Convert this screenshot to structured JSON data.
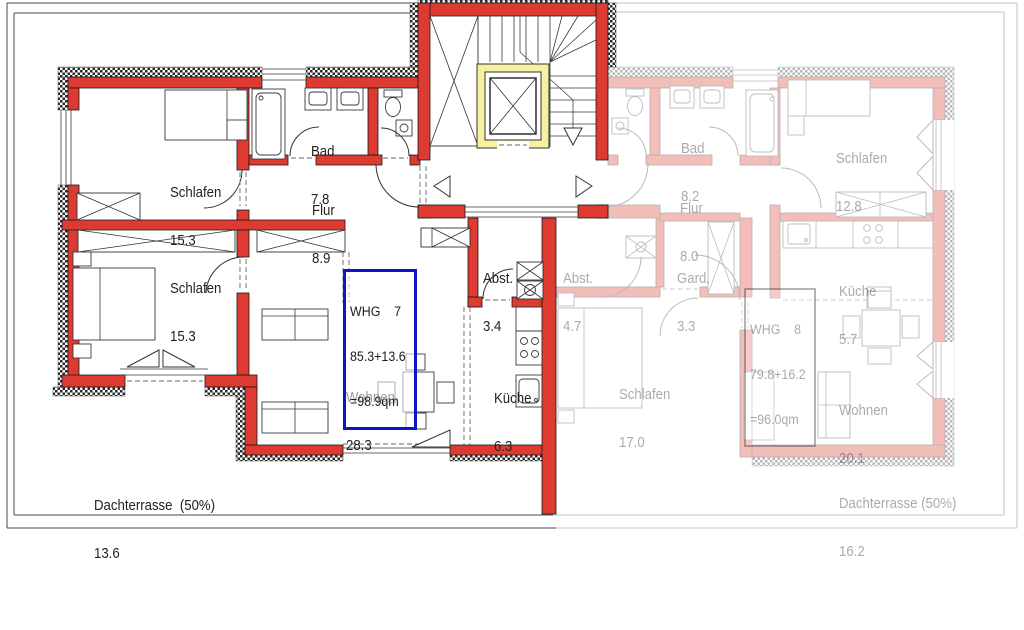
{
  "apartment_7": {
    "unit_box": {
      "line1": "WHG    7",
      "line2": "85.3+13.6",
      "line3": "=98.9qm"
    },
    "rooms": {
      "schlafen_top": {
        "name": "Schlafen",
        "area": "15.3"
      },
      "bad": {
        "name": "Bad",
        "area": "7.8"
      },
      "flur": {
        "name": "Flur",
        "area": "8.9"
      },
      "schlafen_bottom": {
        "name": "Schlafen",
        "area": "15.3"
      },
      "abstellraum": {
        "name": "Abst.",
        "area": "3.4"
      },
      "wohnen": {
        "name": "Wohnen",
        "area": "28.3"
      },
      "kueche": {
        "name": "Küche",
        "area": "6.3"
      },
      "dachterrasse": {
        "name": "Dachterrasse  (50%)",
        "area": "13.6"
      }
    }
  },
  "apartment_8": {
    "unit_box": {
      "line1": "WHG    8",
      "line2": "79.8+16.2",
      "line3": "=96.0qm"
    },
    "rooms": {
      "bad": {
        "name": "Bad",
        "area": "8.2"
      },
      "schlafen_top": {
        "name": "Schlafen",
        "area": "12.8"
      },
      "flur": {
        "name": "Flur",
        "area": "8.0"
      },
      "abstellraum": {
        "name": "Abst.",
        "area": "4.7"
      },
      "garderobe": {
        "name": "Gard.",
        "area": "3.3"
      },
      "kueche": {
        "name": "Küche",
        "area": "5.7"
      },
      "schlafen_bottom": {
        "name": "Schlafen",
        "area": "17.0"
      },
      "wohnen": {
        "name": "Wohnen",
        "area": "20.1"
      },
      "dachterrasse": {
        "name": "Dachterrasse (50%)",
        "area": "16.2"
      }
    }
  },
  "colors": {
    "wall_red": "#dd3a31",
    "elevator_yellow": "#f6f0a0",
    "unit7_border_blue": "#0e14c8"
  }
}
